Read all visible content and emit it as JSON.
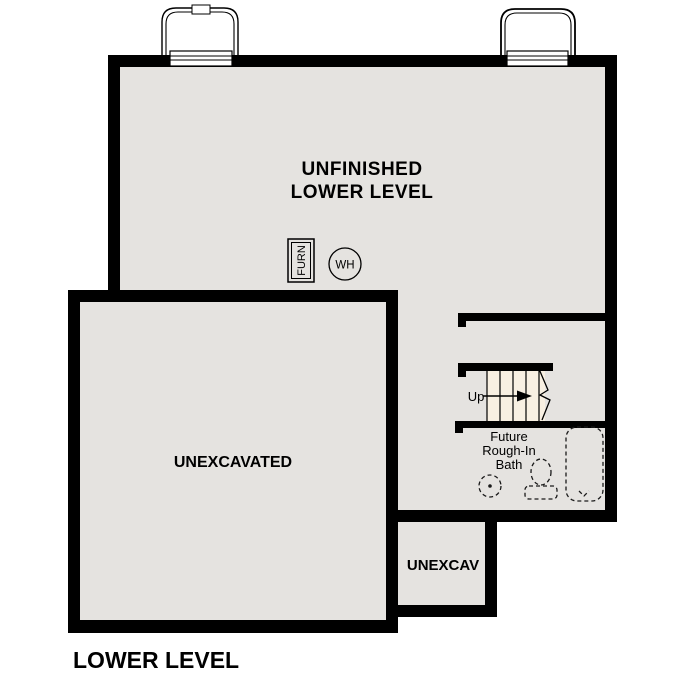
{
  "plan": {
    "title": "LOWER LEVEL",
    "rooms": {
      "unfinished": {
        "line1": "UNFINISHED",
        "line2": "LOWER LEVEL"
      },
      "unexcavated": {
        "label": "UNEXCAVATED"
      },
      "unexcav": {
        "label": "UNEXCAV"
      }
    },
    "stairs": {
      "up_label": "Up"
    },
    "bath": {
      "line1": "Future",
      "line2": "Rough-In",
      "line3": "Bath"
    },
    "equipment": {
      "furnace": "FURN",
      "water_heater": "WH"
    }
  },
  "colors": {
    "wall": "#000000",
    "floor": "#e5e3e0",
    "stair_tread": "#f8f0e2",
    "background": "#ffffff",
    "text": "#000000"
  }
}
